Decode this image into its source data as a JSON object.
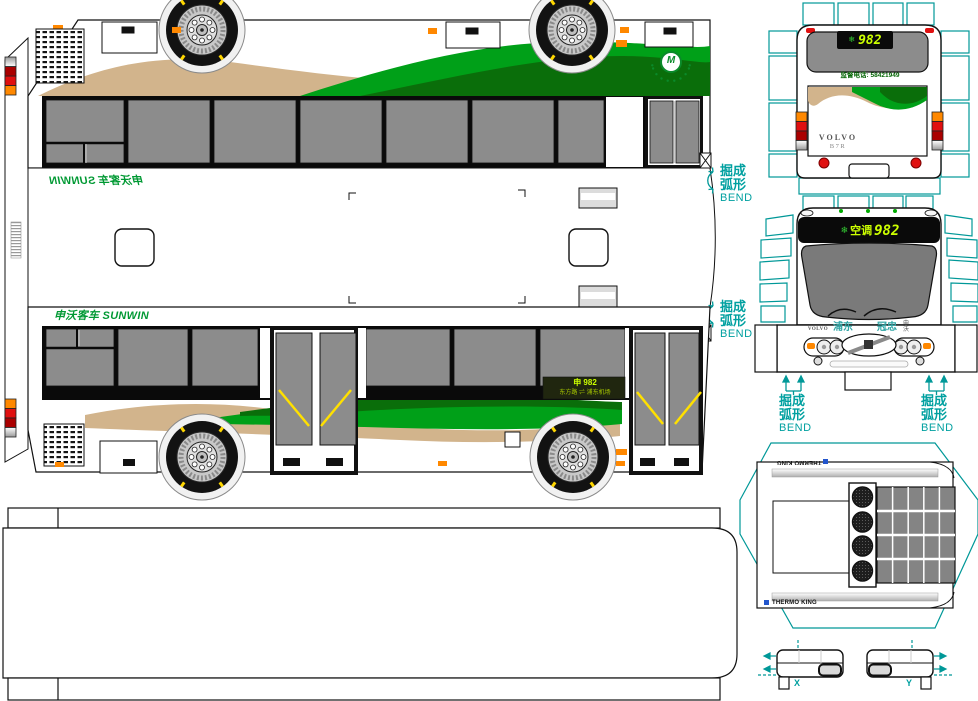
{
  "bend_label": {
    "line1": "掘成",
    "line2": "弧形",
    "line3": "BEND"
  },
  "upper_side": {
    "brand_text": "申沃客车 SUNWIN"
  },
  "lower_side": {
    "brand_text": "申沃客车 SUNWIN",
    "route_sign": {
      "line1": "申 982",
      "line2": "东方路 ⇌ 浦东机场"
    }
  },
  "logo": {
    "letter": "M"
  },
  "rear_view": {
    "led_icon": "❄",
    "led_number": "982",
    "hotline": "监督电话: 58421949",
    "make": "VOLVO",
    "model": "B7R"
  },
  "front_view": {
    "led_icon": "❄",
    "led_ac": "空调",
    "led_number": "982",
    "make": "VOLVO",
    "operator_left": "浦东",
    "operator_right": "冠忠",
    "builder": "申沃"
  },
  "ac_unit": {
    "brand": "THERMO KING"
  },
  "parts": {
    "x": "X",
    "y": "Y"
  },
  "colors": {
    "teal": "#009898",
    "brand_green": "#009933",
    "led_yellow": "#CCFF00",
    "led_green": "#33CC33",
    "orange": "#FF8800",
    "red": "#E01010",
    "dark_red": "#AA0000",
    "tan": "#D2B48C",
    "green_bright": "#00A018",
    "green_dark": "#0A6E0A",
    "window_gray": "#8C8C8C",
    "windshield_gray": "#7A7A7A"
  }
}
